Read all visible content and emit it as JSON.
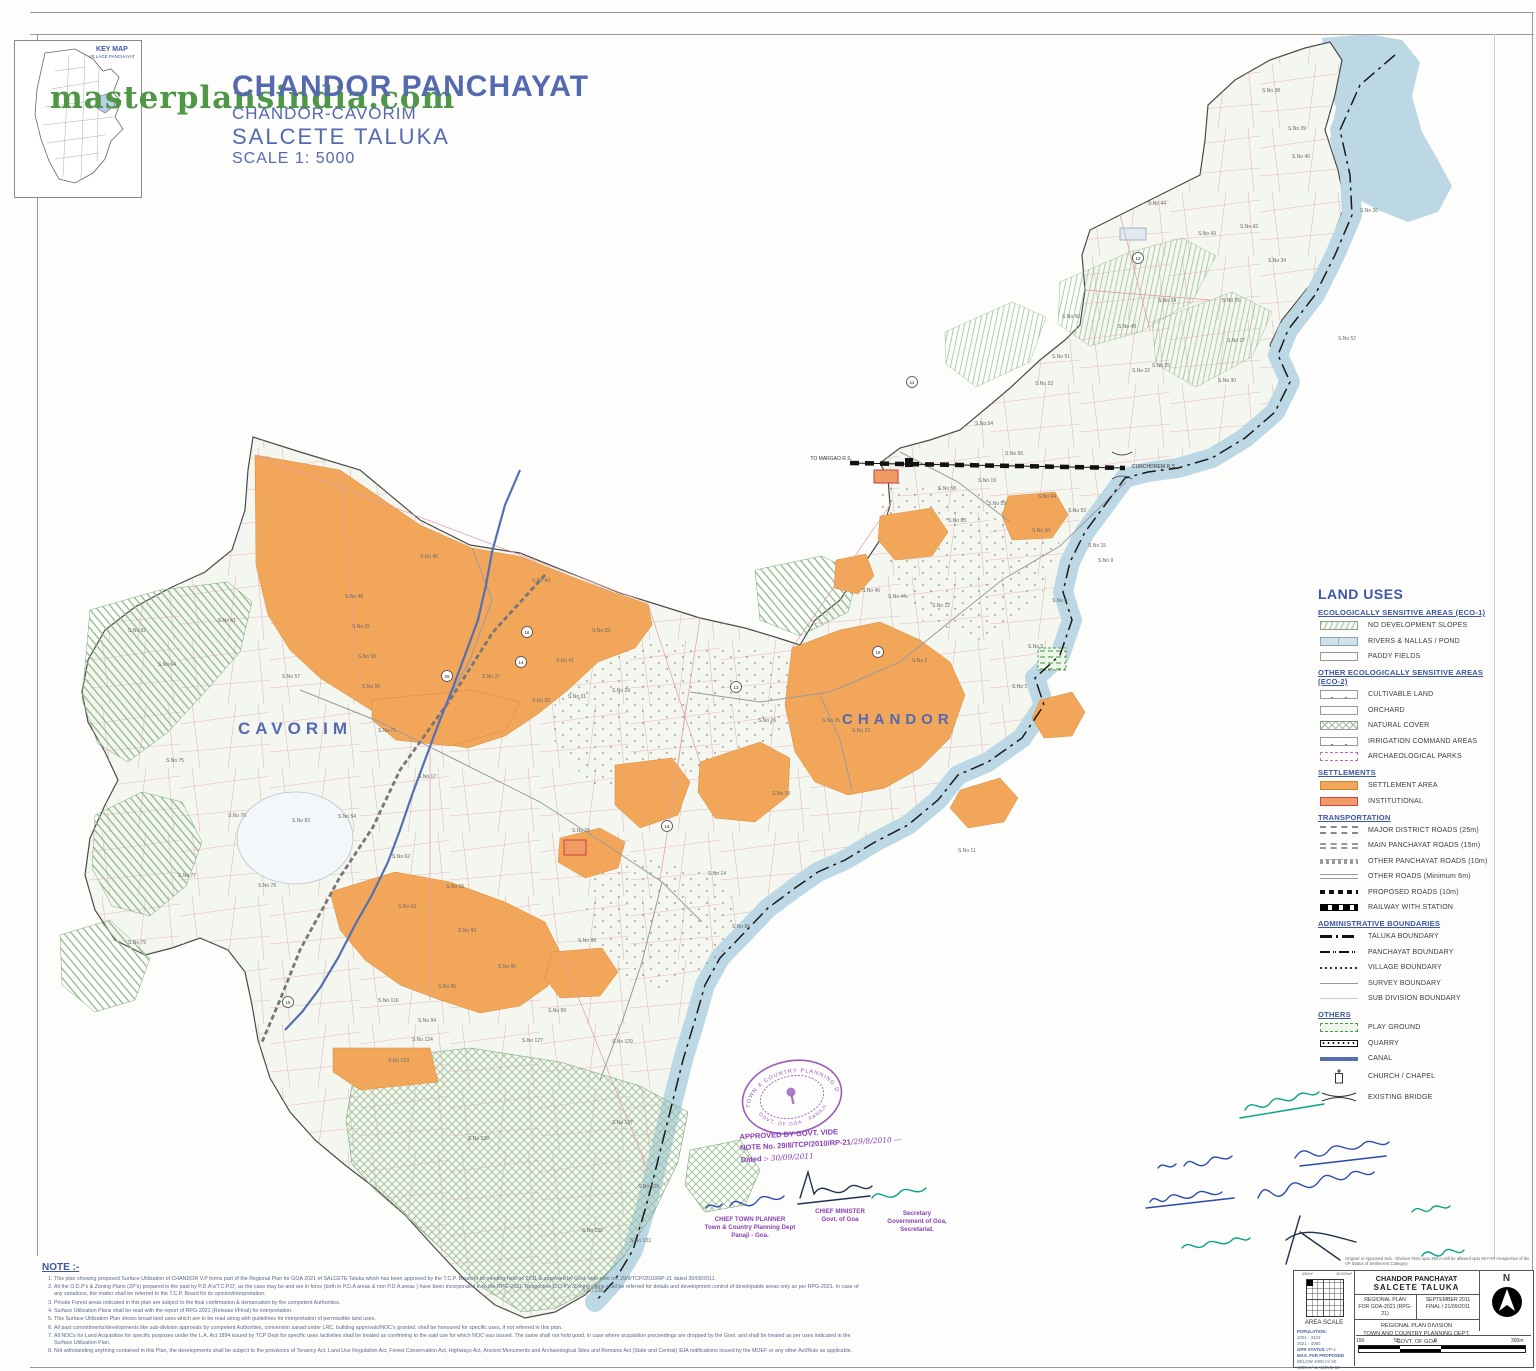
{
  "watermark": "masterplansindia.com",
  "key_map": {
    "title": "KEY MAP",
    "subtitle": "VILLAGE PANCHAYAT"
  },
  "header": {
    "title": "CHANDOR PANCHAYAT",
    "subtitle": "CHANDOR-CAVORIM",
    "taluka": "SALCETE  TALUKA",
    "scale": "SCALE 1: 5000"
  },
  "map": {
    "place_labels": [
      {
        "text": "CAVORIM",
        "x": 238,
        "y": 734,
        "size": 17
      },
      {
        "text": "CHANDOR",
        "x": 842,
        "y": 724,
        "size": 15
      }
    ],
    "rail_labels": [
      {
        "text": "TO MARGAO R.S.",
        "x": 852,
        "y": 460,
        "anchor": "end"
      },
      {
        "text": "CURCHOREM R.S.",
        "x": 1132,
        "y": 468,
        "anchor": "start"
      }
    ],
    "survey_labels": [
      [
        128,
        632,
        "S.No 92"
      ],
      [
        158,
        666,
        "S.No 64"
      ],
      [
        218,
        622,
        "S.No 61"
      ],
      [
        282,
        678,
        "S.No 57"
      ],
      [
        352,
        628,
        "S.No 55"
      ],
      [
        358,
        658,
        "S.No 58"
      ],
      [
        362,
        688,
        "S.No 56"
      ],
      [
        166,
        762,
        "S.No 75"
      ],
      [
        228,
        817,
        "S.No 76"
      ],
      [
        292,
        822,
        "S.No 83"
      ],
      [
        178,
        877,
        "S.No 77"
      ],
      [
        258,
        887,
        "S.No 78"
      ],
      [
        128,
        944,
        "S.No 79"
      ],
      [
        420,
        558,
        "S.No 45"
      ],
      [
        345,
        598,
        "S.No 48"
      ],
      [
        532,
        582,
        "S.No 43"
      ],
      [
        592,
        632,
        "S.No 39"
      ],
      [
        556,
        662,
        "S.No 41"
      ],
      [
        482,
        678,
        "S.No 37"
      ],
      [
        532,
        702,
        "S.No 33"
      ],
      [
        568,
        698,
        "S.No 31"
      ],
      [
        612,
        692,
        "S.No 29"
      ],
      [
        378,
        732,
        "S.No 71"
      ],
      [
        418,
        778,
        "S.No 17"
      ],
      [
        338,
        818,
        "S.No 54"
      ],
      [
        392,
        858,
        "S.No 62"
      ],
      [
        446,
        888,
        "S.No 16"
      ],
      [
        398,
        908,
        "S.No 63"
      ],
      [
        458,
        932,
        "S.No 93"
      ],
      [
        438,
        988,
        "S.No 95"
      ],
      [
        498,
        968,
        "S.No 90"
      ],
      [
        578,
        942,
        "S.No 98"
      ],
      [
        548,
        1012,
        "S.No 99"
      ],
      [
        418,
        1022,
        "S.No 94"
      ],
      [
        378,
        1002,
        "S.No 116"
      ],
      [
        388,
        1062,
        "S.No 123"
      ],
      [
        412,
        1041,
        "S.No 124"
      ],
      [
        522,
        1042,
        "S.No 127"
      ],
      [
        612,
        1043,
        "S.No 129"
      ],
      [
        468,
        1140,
        "S.No 128"
      ],
      [
        612,
        1124,
        "S.No 137"
      ],
      [
        638,
        1188,
        "S.No 139"
      ],
      [
        582,
        1232,
        "S.No 130"
      ],
      [
        630,
        1242,
        "S.No 133"
      ],
      [
        582,
        1292,
        "S.No 138"
      ],
      [
        572,
        832,
        "S.No 15"
      ],
      [
        758,
        722,
        "S.No 26"
      ],
      [
        822,
        722,
        "S.No 25"
      ],
      [
        852,
        732,
        "S.No 23"
      ],
      [
        772,
        795,
        "S.No 18"
      ],
      [
        708,
        875,
        "S.No 14"
      ],
      [
        732,
        928,
        "S.No 86"
      ],
      [
        862,
        592,
        "S.No 46"
      ],
      [
        888,
        598,
        "S.No 44"
      ],
      [
        932,
        607,
        "S.No 12"
      ],
      [
        938,
        490,
        "S.No 58"
      ],
      [
        988,
        505,
        "S.No 59"
      ],
      [
        948,
        522,
        "S.No 63"
      ],
      [
        1032,
        532,
        "S.No 10"
      ],
      [
        1088,
        547,
        "S.No 15"
      ],
      [
        1098,
        562,
        "S.No 9"
      ],
      [
        1052,
        602,
        "S.No 8"
      ],
      [
        1028,
        648,
        "S.No 5"
      ],
      [
        1012,
        688,
        "S.No 1"
      ],
      [
        958,
        852,
        "S.No 11"
      ],
      [
        912,
        662,
        "S.No 2"
      ],
      [
        1262,
        92,
        "S.No 38"
      ],
      [
        1288,
        130,
        "S.No 39"
      ],
      [
        1292,
        158,
        "S.No 40"
      ],
      [
        1148,
        205,
        "S.No 44"
      ],
      [
        1240,
        228,
        "S.No 42"
      ],
      [
        1198,
        235,
        "S.No 43"
      ],
      [
        1360,
        212,
        "S.No 36"
      ],
      [
        1268,
        262,
        "S.No 34"
      ],
      [
        1222,
        302,
        "S.No 26"
      ],
      [
        1227,
        342,
        "S.No 27"
      ],
      [
        1158,
        302,
        "S.No 24"
      ],
      [
        1062,
        318,
        "S.No 50"
      ],
      [
        1118,
        328,
        "S.No 49"
      ],
      [
        1338,
        340,
        "S.No 52"
      ],
      [
        1052,
        358,
        "S.No 51"
      ],
      [
        1132,
        372,
        "S.No 32"
      ],
      [
        1218,
        382,
        "S.No 30"
      ],
      [
        1035,
        385,
        "S.No 23"
      ],
      [
        1152,
        367,
        "S.No 25"
      ],
      [
        975,
        425,
        "S.No 54"
      ],
      [
        1005,
        455,
        "S.No 56"
      ],
      [
        978,
        482,
        "S.No 19"
      ],
      [
        1038,
        498,
        "S.No 64"
      ],
      [
        1068,
        512,
        "S.No 53"
      ]
    ],
    "road_markers": [
      [
        527,
        632,
        "16"
      ],
      [
        521,
        662,
        "14"
      ],
      [
        447,
        676,
        "29"
      ],
      [
        736,
        687,
        "13"
      ],
      [
        878,
        652,
        "18"
      ],
      [
        912,
        382,
        "11"
      ],
      [
        667,
        826,
        "16"
      ],
      [
        288,
        1002,
        "15"
      ],
      [
        1138,
        258,
        "12"
      ]
    ]
  },
  "legend": {
    "title": "LAND USES",
    "sections": [
      {
        "heading": "ECOLOGICALLY SENSITIVE AREAS (ECO-1)",
        "items": [
          {
            "label": "NO DEVELOPMENT SLOPES",
            "swatch": "slopes"
          },
          {
            "label": "RIVERS & NALLAS / POND",
            "swatch": "water"
          },
          {
            "label": "PADDY FIELDS",
            "swatch": "paddy"
          }
        ]
      },
      {
        "heading": "OTHER ECOLOGICALLY SENSITIVE AREAS (ECO-2)",
        "items": [
          {
            "label": "CULTIVABLE LAND",
            "swatch": "cultivable"
          },
          {
            "label": "ORCHARD",
            "swatch": "orchard"
          },
          {
            "label": "NATURAL COVER",
            "swatch": "natural"
          },
          {
            "label": "IRRIGATION COMMAND AREAS",
            "swatch": "irrigation"
          },
          {
            "label": "ARCHAEOLOGICAL PARKS",
            "swatch": "arch"
          }
        ]
      },
      {
        "heading": "SETTLEMENTS",
        "items": [
          {
            "label": "SETTLEMENT AREA",
            "swatch": "settlement"
          },
          {
            "label": "INSTITUTIONAL",
            "swatch": "institutional"
          }
        ]
      },
      {
        "heading": "TRANSPORTATION",
        "items": [
          {
            "label": "MAJOR DISTRICT  ROADS (25m)",
            "swatch": "mdr"
          },
          {
            "label": "MAIN PANCHAYAT ROADS (15m)",
            "swatch": "mpr"
          },
          {
            "label": "OTHER PANCHAYAT ROADS (10m)",
            "swatch": "opr"
          },
          {
            "label": "OTHER  ROADS (Minimum 6m)",
            "swatch": "other"
          },
          {
            "label": "PROPOSED ROADS (10m)",
            "swatch": "proposed"
          },
          {
            "label": "RAILWAY WITH STATION",
            "swatch": "railway"
          }
        ]
      },
      {
        "heading": "ADMINISTRATIVE BOUNDARIES",
        "items": [
          {
            "label": "TALUKA BOUNDARY",
            "swatch": "taluka"
          },
          {
            "label": "PANCHAYAT BOUNDARY",
            "swatch": "panchayat"
          },
          {
            "label": "VILLAGE BOUNDARY",
            "swatch": "village"
          },
          {
            "label": "SURVEY BOUNDARY",
            "swatch": "survey"
          },
          {
            "label": "SUB DIVISION BOUNDARY",
            "swatch": "subdiv"
          }
        ]
      },
      {
        "heading": "OTHERS",
        "items": [
          {
            "label": "PLAY GROUND",
            "swatch": "playground"
          },
          {
            "label": "QUARRY",
            "swatch": "quarry"
          },
          {
            "label": "CANAL",
            "swatch": "canal"
          },
          {
            "label": "CHURCH / CHAPEL",
            "swatch": "church"
          },
          {
            "label": "EXISTING BRIDGE",
            "swatch": "bridge"
          }
        ]
      }
    ]
  },
  "notes": {
    "title": "NOTE :-",
    "items": [
      "This plan showing proposed Surface Utilization of CHANDOR V.P forms part of the Regional Plan for GOA 2021 of SALCETE Taluka which has been approved by the T.C.P. Board in its  meeting held on 2011 & approved by Govt. vide note no. 29/8/TCP/2010/RP-21 dated 30/09/2011.",
      "All the O.D.P's & Zoning Plans (ZP's) prepared in the past by P.D.A's/T.C.P.D', as the case may be and are in force (both in P.D.A areas & non P.D.A areas ) have been incorporated in to the RPG-2021. Respective O.D.P's /Zoning Plans shall be referred for details and development control of developable areas only as per RPG-2021. In case of any variations, the matter shall be referred to the T.C.P. Board  for its opinion/interpretation.",
      "Private Forest areas indicated in this plan are subject to the final confirmation & demarcation by the competent Authorities.",
      "Surface Utilization Plans shall be read with the report of RPG-2021 (Release I/Final) for interpretation.",
      "This Surface Utilization Plan shows broad land uses which are to be read along with guidelines for interpretation of permissible land uses.",
      "All past commitments/developments like sub-division approvals by competent Authorities, conversion sanad under LRC, building approvals/NOC's  granted, shall be honoured for specific uses, if not referred in this plan.",
      "All NOCs for Land Acquisition for specific purposes under the L.A. Act 1894 issued by TCP Dept for specific uses /activities shall be treated as confirming to the said use for which NOC  was issued. The same shall not hold good, in case where acquisition proceedings are dropped by the Govt. and shall be treated as per uses indicated in the Surface Utilization Plan.",
      "Not withstanding anything contained in this Plan, the developments shall be subject to the provisions of Tenancy Act, Land Use Regulation Act, Forest Conservation Act, Highways Act, Ancient Monuments and Archaeological Sites and Remains Act (State and Central) /EIA notifications issued by the MOEF or any other Act/Rule as applicable."
    ]
  },
  "approval": {
    "line1": "APPROVED BY GOVT. VIDE",
    "line2_prefix": "NOTE No. 29/8/TCP/2010/RP-21",
    "line2_hand": "/29/8/2010 —",
    "line3_prefix": "Dated :-",
    "line3_hand": "30/09/2011",
    "stamp_top": "TOWN & COUNTRY PLANNING DEPT.",
    "stamp_bottom": "GOVT. OF GOA · PANAJI"
  },
  "signature_captions": [
    {
      "lines": [
        "CHIEF TOWN PLANNER",
        "Town & Country Planning Dept",
        "Panaji - Goa."
      ]
    },
    {
      "lines": [
        "CHIEF MINISTER",
        "Govt. of Goa"
      ]
    },
    {
      "lines": [
        "Secretary",
        "Government of Goa,",
        "Secretariat."
      ]
    }
  ],
  "title_block": {
    "top_note": "Original or Approved  Sub - Division Plots upto 350 m will be allowed upto 80 FAR irrespective of the VP Status of Settlement Category",
    "area_scale": {
      "label": "AREA SCALE",
      "left_val": "400m²",
      "right_val": "10,000m²"
    },
    "stats": {
      "population_title": "POPULATION:",
      "pop_rows": [
        "2001 - 3423",
        "2021 - 4080"
      ],
      "gpr_title": "GPR STATUS",
      "gpr_val": "VP-2",
      "far_title": "MAX. FAR PROPOSED",
      "far_rows": [
        "BELOW 4000 m²   50",
        "4000 m² & ABOVE  50"
      ]
    },
    "name": "CHANDOR PANCHAYAT",
    "taluka": "SALCETE  TALUKA",
    "plan_line1": "REGIONAL PLAN",
    "plan_line2": "FOR GOA-2021 (RPG-21)",
    "date_line1": "SEPTEMBER 2011",
    "date_line2": "FINAL / 21/09/2011",
    "division": "REGIONAL PLAN DIVISION",
    "dept": "TOWN AND COUNTRY PLANNING DEPT.",
    "govt": "GOVT. OF GOA",
    "north_label": "N",
    "scalebar_labels": [
      "150",
      "50",
      "0",
      "300m"
    ]
  },
  "colors": {
    "title_blue": "#5569b0",
    "heading_blue": "#3d56a6",
    "settlement": "#f2a65a",
    "institutional_border": "#cc4444",
    "river": "#bdd8e5",
    "canal": "#5570b0",
    "hatch_green": "#8fb78a",
    "watermark_green": "#4f9747",
    "stamp_purple": "#8a3fb5",
    "signature_blue": "#2a4bb0",
    "signature_teal": "#0aa285",
    "note_text": "#5a6a8a"
  }
}
